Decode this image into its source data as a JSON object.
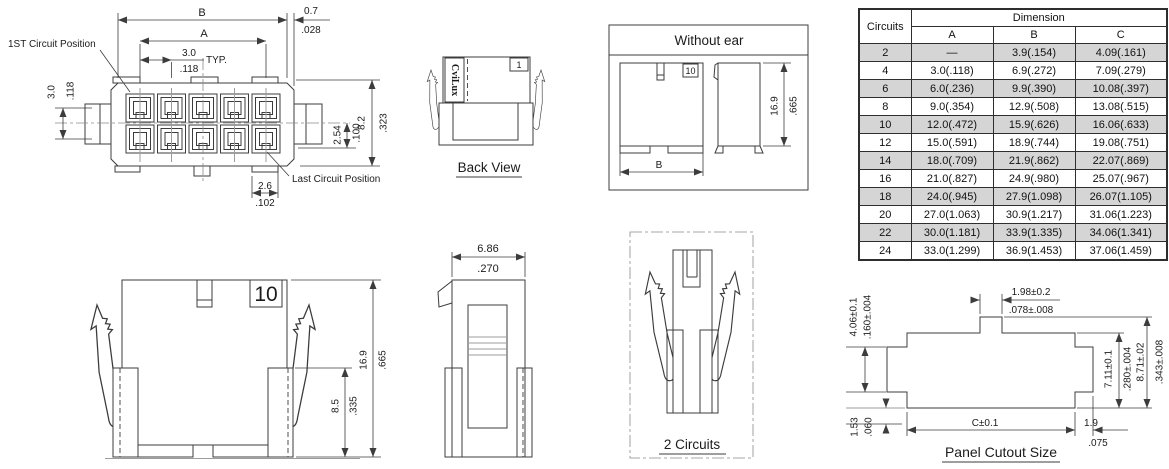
{
  "front_view": {
    "first_circuit_label": "1ST Circuit Position",
    "last_circuit_label": "Last Circuit Position",
    "dim_b": "B",
    "dim_a": "A",
    "dim_edge_mm": "0.7",
    "dim_edge_in": ".028",
    "pitch_mm": "3.0",
    "pitch_in": ".118",
    "typ": "TYP.",
    "row_pitch_mm": "3.0",
    "row_pitch_in": ".118",
    "row_offset_mm": "2.54",
    "row_offset_in": ".100",
    "height_mm": "8.2",
    "height_in": ".323",
    "cavity_mm": "2.6",
    "cavity_in": ".102"
  },
  "back_view": {
    "title": "Back View",
    "brand": "CviLux",
    "pin1": "1"
  },
  "without_ear": {
    "title": "Without ear",
    "pin10": "10",
    "dim_b": "B",
    "height_mm": "16.9",
    "height_in": ".665"
  },
  "front_with_ears": {
    "pin10": "10",
    "height_mm": "16.9",
    "height_in": ".665",
    "inner_height_mm": "8.5",
    "inner_height_in": ".335"
  },
  "side_profile": {
    "width_mm": "6.86",
    "width_in": ".270"
  },
  "two_circuits": {
    "title": "2 Circuits"
  },
  "panel_cutout": {
    "title": "Panel Cutout Size",
    "tab_mm": "1.98±0.2",
    "tab_in": ".078±.008",
    "notch_mm": "4.06±0.1",
    "notch_in": ".160±.004",
    "lower_mm": "1.53",
    "lower_in": ".060",
    "inner_h_mm": "7.11±0.1",
    "inner_h_in": ".280±.004",
    "outer_h_mm": "8.71±.02",
    "outer_h_in": ".343±.008",
    "width_c": "C±0.1",
    "right_mm": "1.9",
    "right_in": ".075"
  },
  "table": {
    "header": {
      "circuits": "Circuits",
      "dimension": "Dimension",
      "a": "A",
      "b": "B",
      "c": "C"
    },
    "rows": [
      {
        "circuits": "2",
        "a": "—",
        "b": "3.9(.154)",
        "c": "4.09(.161)"
      },
      {
        "circuits": "4",
        "a": "3.0(.118)",
        "b": "6.9(.272)",
        "c": "7.09(.279)"
      },
      {
        "circuits": "6",
        "a": "6.0(.236)",
        "b": "9.9(.390)",
        "c": "10.08(.397)"
      },
      {
        "circuits": "8",
        "a": "9.0(.354)",
        "b": "12.9(.508)",
        "c": "13.08(.515)"
      },
      {
        "circuits": "10",
        "a": "12.0(.472)",
        "b": "15.9(.626)",
        "c": "16.06(.633)"
      },
      {
        "circuits": "12",
        "a": "15.0(.591)",
        "b": "18.9(.744)",
        "c": "19.08(.751)"
      },
      {
        "circuits": "14",
        "a": "18.0(.709)",
        "b": "21.9(.862)",
        "c": "22.07(.869)"
      },
      {
        "circuits": "16",
        "a": "21.0(.827)",
        "b": "24.9(.980)",
        "c": "25.07(.967)"
      },
      {
        "circuits": "18",
        "a": "24.0(.945)",
        "b": "27.9(1.098)",
        "c": "26.07(1.105)"
      },
      {
        "circuits": "20",
        "a": "27.0(1.063)",
        "b": "30.9(1.217)",
        "c": "31.06(1.223)"
      },
      {
        "circuits": "22",
        "a": "30.0(1.181)",
        "b": "33.9(1.335)",
        "c": "34.06(1.341)"
      },
      {
        "circuits": "24",
        "a": "33.0(1.299)",
        "b": "36.9(1.453)",
        "c": "37.06(1.459)"
      }
    ]
  }
}
